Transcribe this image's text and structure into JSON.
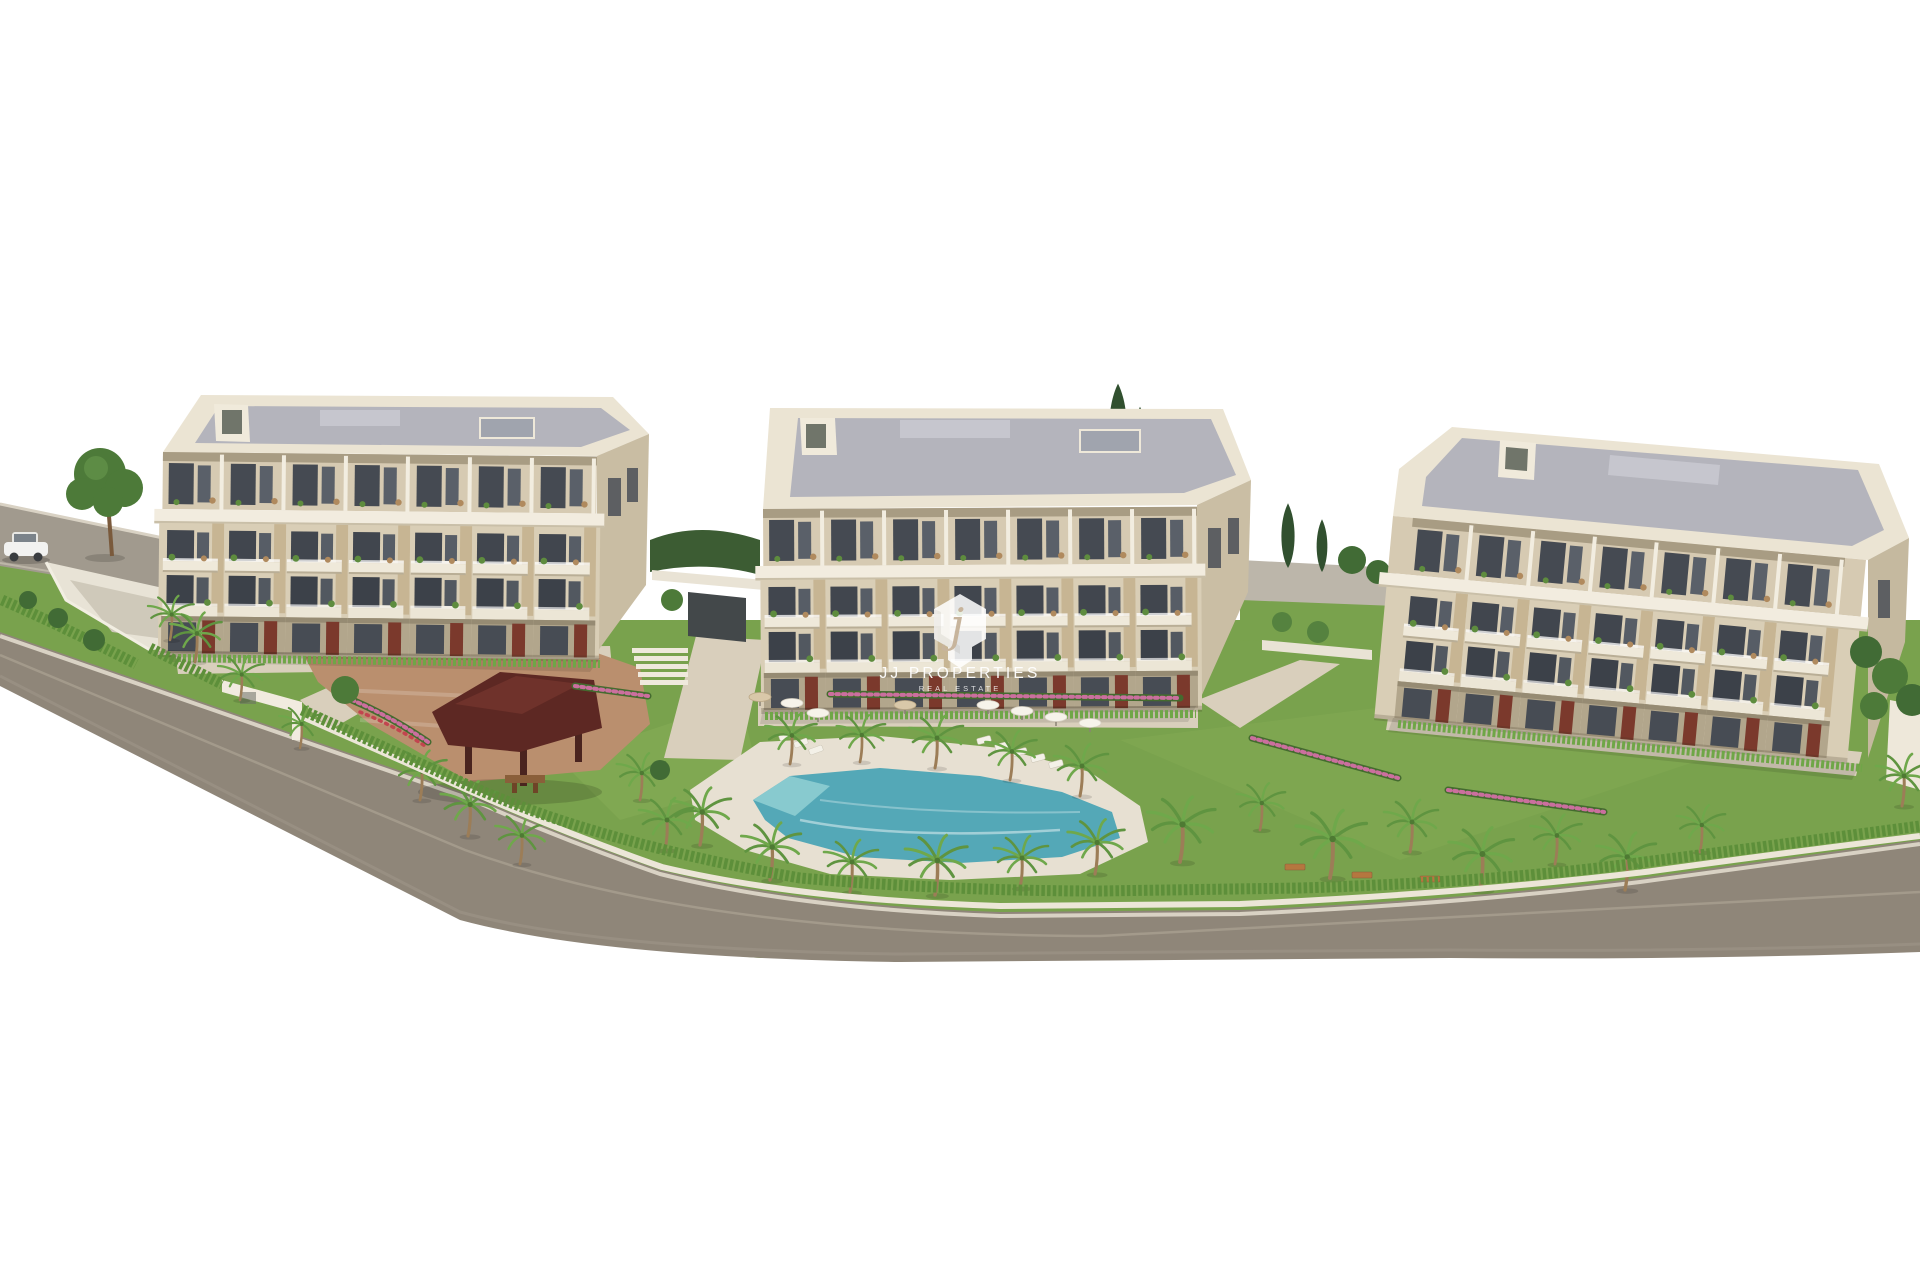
{
  "watermark": {
    "initial": "j",
    "brand": "JJ PROPERTIES",
    "tagline": "REAL ESTATE"
  },
  "scene": {
    "type": "3d-architectural-render",
    "buildings_count": 3
  },
  "palette": {
    "background": "#ffffff",
    "road": "#8f8679",
    "road_upper": "#a19a8e",
    "curb": "#d9d2c4",
    "lawn": "#79a24d",
    "hedge": "#5d8f3a",
    "path": "#d9cfbc",
    "pool_deck": "#e7e0d2",
    "plaza_tan": "#ba8f6e",
    "pool_water": "#54a8b7",
    "pool_light": "#8ecdd2",
    "gazebo_roof": "#5d2823",
    "facade": "#d9ceb6",
    "parapet": "#ebe4d3",
    "roof_deck": "#b4b4bc",
    "window": "#41464e",
    "terracotta": "#7b392c",
    "palm": "#5f9440",
    "cypress": "#31502f",
    "car": "#f2f2f0"
  }
}
